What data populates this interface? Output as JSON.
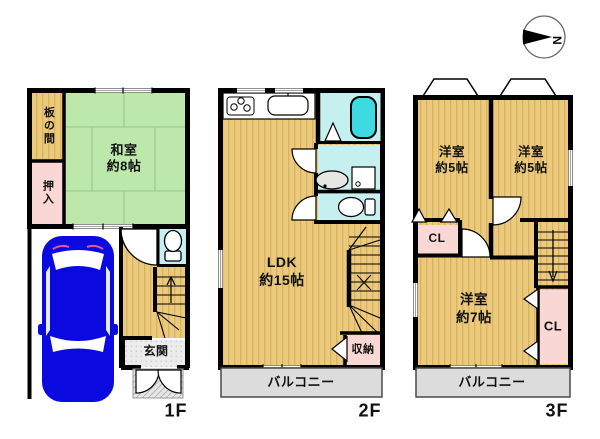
{
  "compass": {
    "north": "N"
  },
  "floor1": {
    "label": "1F",
    "itanoma": "板の間",
    "oshiire": "押入",
    "washitsu_name": "和室",
    "washitsu_size": "約8帖",
    "genkan": "玄関"
  },
  "floor2": {
    "label": "2F",
    "ldk_name": "LDK",
    "ldk_size": "約15帖",
    "shunou": "収納",
    "balcony": "バルコニー"
  },
  "floor3": {
    "label": "3F",
    "room_left_name": "洋室",
    "room_left_size": "約5帖",
    "room_right_name": "洋室",
    "room_right_size": "約5帖",
    "room_main_name": "洋室",
    "room_main_size": "約7帖",
    "closet_left": "CL",
    "closet_right": "CL",
    "balcony": "バルコニー"
  },
  "colors": {
    "wood_floor": "#ebc97d",
    "wood_stripe": "#d8b25e",
    "tatami_green": "#bce8ab",
    "closet_pink": "#f8d7d4",
    "wet_area_cyan": "#c6f0f0",
    "bathtub_cyan": "#3ed9e2",
    "balcony_gray": "#dcdcdc",
    "entrance_gray": "#ececec",
    "car_blue": "#0a0ae0",
    "wall_black": "#000000"
  }
}
